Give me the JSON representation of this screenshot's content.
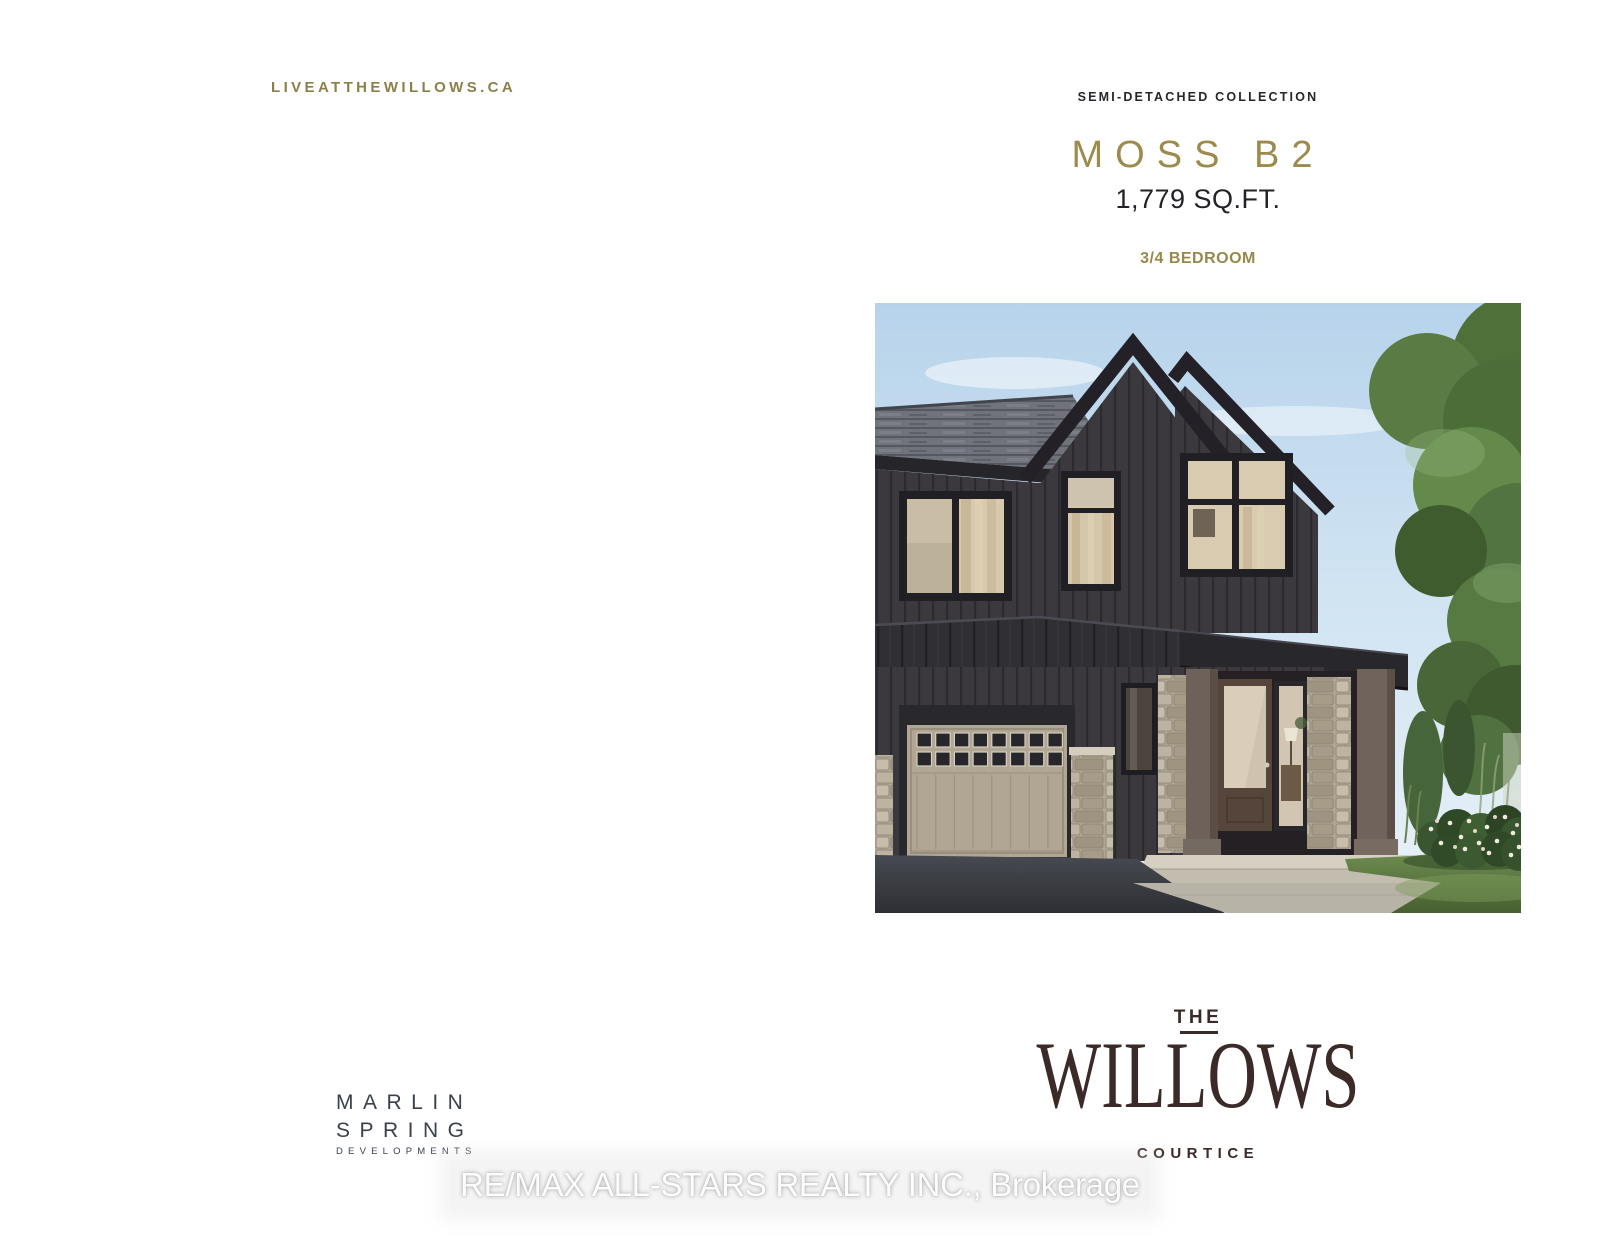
{
  "brand": {
    "website_url": "LIVEATTHEWILLOWS.CA"
  },
  "header": {
    "collection_label": "SEMI-DETACHED COLLECTION",
    "model_name": "MOSS B2",
    "square_footage": "1,779 SQ.FT.",
    "bedrooms_label": "3/4 BEDROOM"
  },
  "community_logo": {
    "prefix": "THE",
    "name": "WILLOWS",
    "city": "COURTICE"
  },
  "developer_logo": {
    "name_line1": "MARLIN",
    "name_line2": "SPRING",
    "tagline": "DEVELOPMENTS"
  },
  "watermark": {
    "text": "RE/MAX ALL-STARS REALTY INC., Brokerage"
  },
  "colors": {
    "gold": "#9c8b4c",
    "gold_olive": "#8c8049",
    "ink": "#26262b",
    "willows_brown": "#3b2a27",
    "marlin_slate": "#3a414d"
  }
}
